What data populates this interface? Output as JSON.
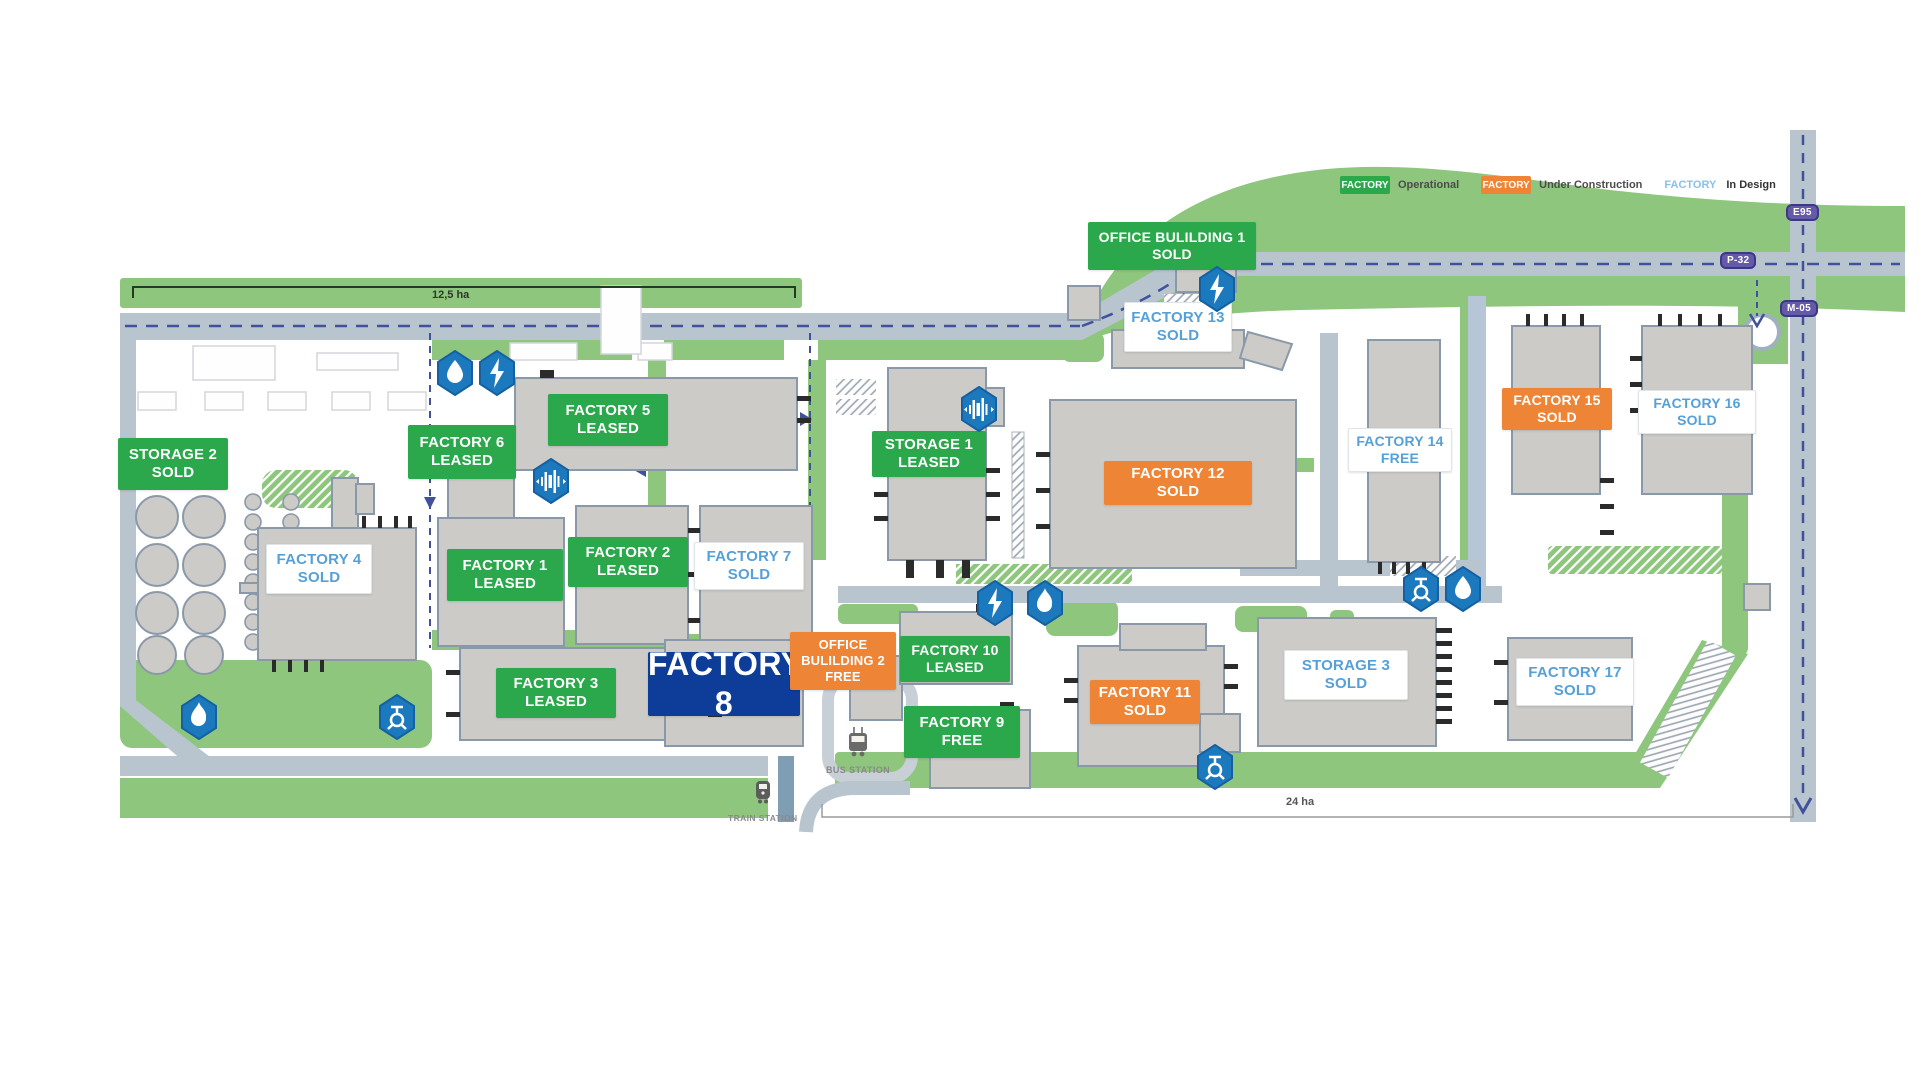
{
  "legend": {
    "operational": {
      "badge": "FACTORY",
      "label": "Operational"
    },
    "under_construction": {
      "badge": "FACTORY",
      "label": "Under Construction"
    },
    "in_design": {
      "badge": "FACTORY",
      "label": "In Design"
    }
  },
  "road_signs": {
    "e95": "E95",
    "p32": "P-32",
    "m05": "M-05"
  },
  "area_labels": {
    "west": "12,5 ha",
    "east": "24 ha"
  },
  "stations": {
    "bus": "BUS STATION",
    "train": "TRAIN STATION"
  },
  "plots": [
    {
      "name": "STORAGE 2",
      "status": "SOLD"
    },
    {
      "name": "FACTORY 4",
      "status": "SOLD"
    },
    {
      "name": "FACTORY 6",
      "status": "LEASED"
    },
    {
      "name": "FACTORY 5",
      "status": "LEASED"
    },
    {
      "name": "FACTORY 1",
      "status": "LEASED"
    },
    {
      "name": "FACTORY 2",
      "status": "LEASED"
    },
    {
      "name": "FACTORY 7",
      "status": "SOLD"
    },
    {
      "name": "FACTORY 3",
      "status": "LEASED"
    },
    {
      "name": "FACTORY 8",
      "status": ""
    },
    {
      "name": "OFFICE BULILDING 2",
      "status": "FREE"
    },
    {
      "name": "FACTORY 10",
      "status": "LEASED"
    },
    {
      "name": "FACTORY 9",
      "status": "FREE"
    },
    {
      "name": "STORAGE 1",
      "status": "LEASED"
    },
    {
      "name": "FACTORY 12",
      "status": "SOLD"
    },
    {
      "name": "FACTORY 11",
      "status": "SOLD"
    },
    {
      "name": "STORAGE 3",
      "status": "SOLD"
    },
    {
      "name": "OFFICE BULILDING 1",
      "status": "SOLD"
    },
    {
      "name": "FACTORY 13",
      "status": "SOLD"
    },
    {
      "name": "FACTORY 14",
      "status": "FREE"
    },
    {
      "name": "FACTORY 15",
      "status": "SOLD"
    },
    {
      "name": "FACTORY 16",
      "status": "SOLD"
    },
    {
      "name": "FACTORY 17",
      "status": "SOLD"
    }
  ],
  "icons": {
    "water": "water-drop",
    "electricity": "lightning-bolt",
    "gas": "flame",
    "drainage": "valve",
    "pumping": "pump-bars",
    "bus": "bus",
    "train": "train"
  },
  "colors": {
    "operational_green": "#2aa84b",
    "under_construction_orange": "#ee8435",
    "in_design_blue": "#56a0d8",
    "selected_navy": "#0d3d99",
    "road_gray": "#b8c5cf",
    "green_area": "#8ec67e",
    "utility_icon_blue": "#1d79bd",
    "road_sign_purple": "#655aa8"
  }
}
